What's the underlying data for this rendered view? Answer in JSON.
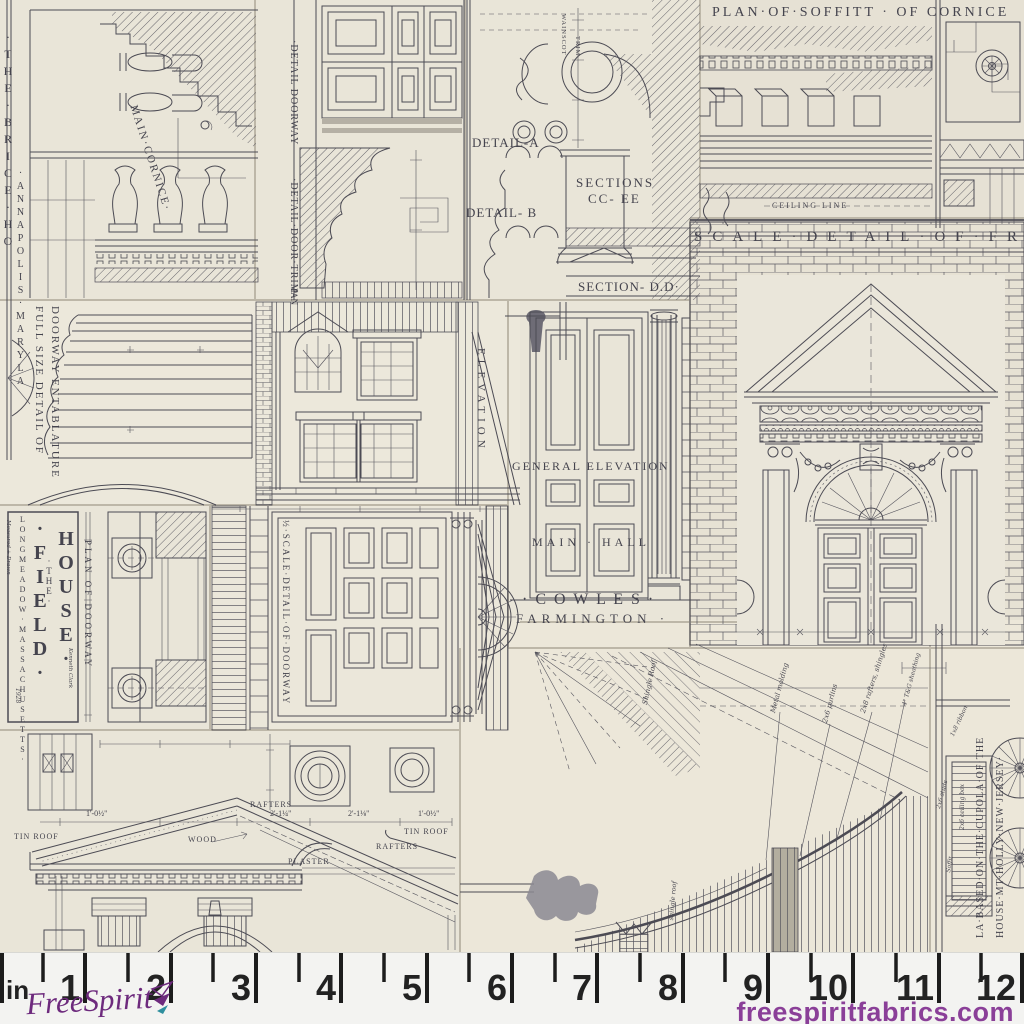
{
  "colors": {
    "paper": "#e9e5d8",
    "ink": "#4c4b54",
    "ruler_bg": "#f3f3f1",
    "tick": "#1c1c1c",
    "brand_purple": "#6d2a7d",
    "website_purple": "#8a3f98",
    "accent_teal": "#2e8f9e"
  },
  "panels": {
    "brice": {
      "title_col1": "·THE·BRICE·HO",
      "title_col2": "·ANNAPOLIS·MARYLA",
      "main_cornice": "MAIN·CORNICE·"
    },
    "soffit": {
      "title": "PLAN·OF·SOFFITT · OF CORNICE",
      "ceiling_line": "CEILING LINE"
    },
    "details": {
      "detail_a": "DETAIL-A",
      "detail_b": "DETAIL- B",
      "sections_1": "SECTIONS",
      "sections_2": "CC- EE",
      "section_dd": "SECTION- D.D·",
      "wainscot": "WAINSCOT",
      "trim": "TRIM"
    },
    "door_trim": {
      "doorway": "·DETAIL DOORWAY",
      "trim": "·DETAIL·DOOR·TRIM",
      "pan": "PAN"
    },
    "front": {
      "title": "SCALE·DETAIL·OF·FRONT"
    },
    "entablature": {
      "line1": "FULL SIZE DETAIL OF",
      "line2": "DOORWAY ENTABLATURE"
    },
    "house": {
      "elevation": "ELEVATION"
    },
    "cowles": {
      "general_elevation": "GENERAL ELEVATION",
      "main_hall": "MAIN · HALL",
      "cowles": "· C O W L E S ·",
      "farmington": "FARMINGTON ·"
    },
    "field_house": {
      "the": "·THE·",
      "field": "·FIELD·",
      "house": "HOUSE·",
      "location": "LONGMEADOW·MASSACHUSETTS·",
      "credit_left": "Measured + Drawn",
      "credit_right": "Kenneth Clark",
      "year": "1928",
      "plan_of_doorway": "PLAN OF DOORWAY"
    },
    "doorway_half": {
      "label": "½·SCALE·DETAIL·OF·DOORWAY"
    },
    "roof": {
      "tin_roof_left": "TIN ROOF",
      "rafters_top": "RAFTERS",
      "wood": "WOOD",
      "plaster": "PLASTER",
      "tin_roof_right": "TIN ROOF",
      "rafters_right": "RAFTERS",
      "dim_1": "1'-0½\"",
      "dim_2": "2'-1¼\"",
      "dim_3": "2'-1⅛\"",
      "dim_4": "1'-0½\""
    },
    "cupola": {
      "title_line1": "LA·BASED·ON·THE·CUPOLA·OF·THE",
      "title_line2": "HOUSE·MT·HOLLY·NEW·JERSEY·",
      "note_ribbon": "1x8 ribbon",
      "note_ceiling": "2x6 ceiling box",
      "note_studs": "2x6 studs",
      "note_soffit": "Soffit"
    },
    "eave": {
      "note_shingle": "Shingle Roof",
      "note_metal": "Metal molding",
      "note_purlins": "2x6 purlins",
      "note_rafters": "2x8 rafters, shingles",
      "note_sheathing": "4\" T&G sheathing",
      "note_shingle2": "shingle roof"
    }
  },
  "ruler": {
    "unit": "in",
    "numbers": [
      "1",
      "2",
      "3",
      "4",
      "5",
      "6",
      "7",
      "8",
      "9",
      "10",
      "11",
      "12"
    ]
  },
  "footer": {
    "brand": "FreeSpirit",
    "website": "freespiritfabrics.com"
  }
}
